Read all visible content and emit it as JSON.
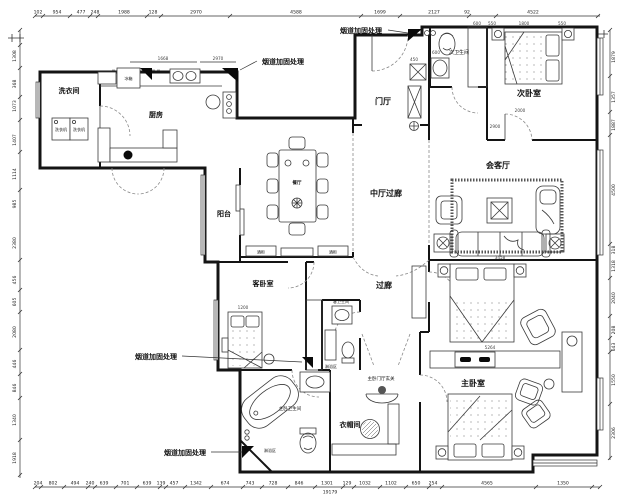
{
  "drawing": {
    "flue_note": "烟道加固处理",
    "rooms": {
      "laundry": "洗衣间",
      "kitchen": "厨房",
      "balcony": "阳台",
      "dining": "餐厅",
      "central_hall": "中厅过廊",
      "foyer": "门厅",
      "second_bath": "次卫生间",
      "second_bedroom": "次卧室",
      "living": "会客厅",
      "guest_bedroom": "客卧室",
      "corridor": "过廊",
      "guest_bath": "客卫生间",
      "shower_guest": "淋浴区",
      "master_bath": "主卧卫生间",
      "shower_master": "淋浴区",
      "cloakroom": "衣帽间",
      "master_bedroom": "主卧室",
      "master_foyer": "主卧门厅玄关"
    },
    "furniture": {
      "fridge": "冰箱",
      "washer_a": "洗衣机",
      "washer_b": "洗衣机",
      "wine_a": "酒柜",
      "wine_b": "酒柜"
    },
    "dims": {
      "top": [
        "102",
        "954",
        "477",
        "248",
        "1988",
        "128",
        "2970",
        "4588",
        "1699",
        "2127",
        "92",
        "4522"
      ],
      "bottom": [
        "204",
        "802",
        "494",
        "240",
        "639",
        "701",
        "639",
        "139",
        "457",
        "1342",
        "674",
        "743",
        "728",
        "846",
        "1301",
        "129",
        "1032",
        "1102",
        "650",
        "254",
        "4565",
        "1350"
      ],
      "bottom_total": "19179",
      "left": [
        "1308",
        "368",
        "1073",
        "1407",
        "1114",
        "985",
        "2380",
        "456",
        "605",
        "2080",
        "446",
        "846",
        "1340",
        "1918"
      ],
      "right": [
        "1879",
        "1357",
        "1887",
        "4500",
        "318",
        "1318",
        "2040",
        "208",
        "643",
        "1550",
        "2306"
      ],
      "inner": [
        "1668",
        "2970",
        "600",
        "550",
        "1800",
        "550",
        "2000",
        "2900",
        "3458",
        "5264",
        "1200",
        "450",
        "600"
      ]
    }
  }
}
